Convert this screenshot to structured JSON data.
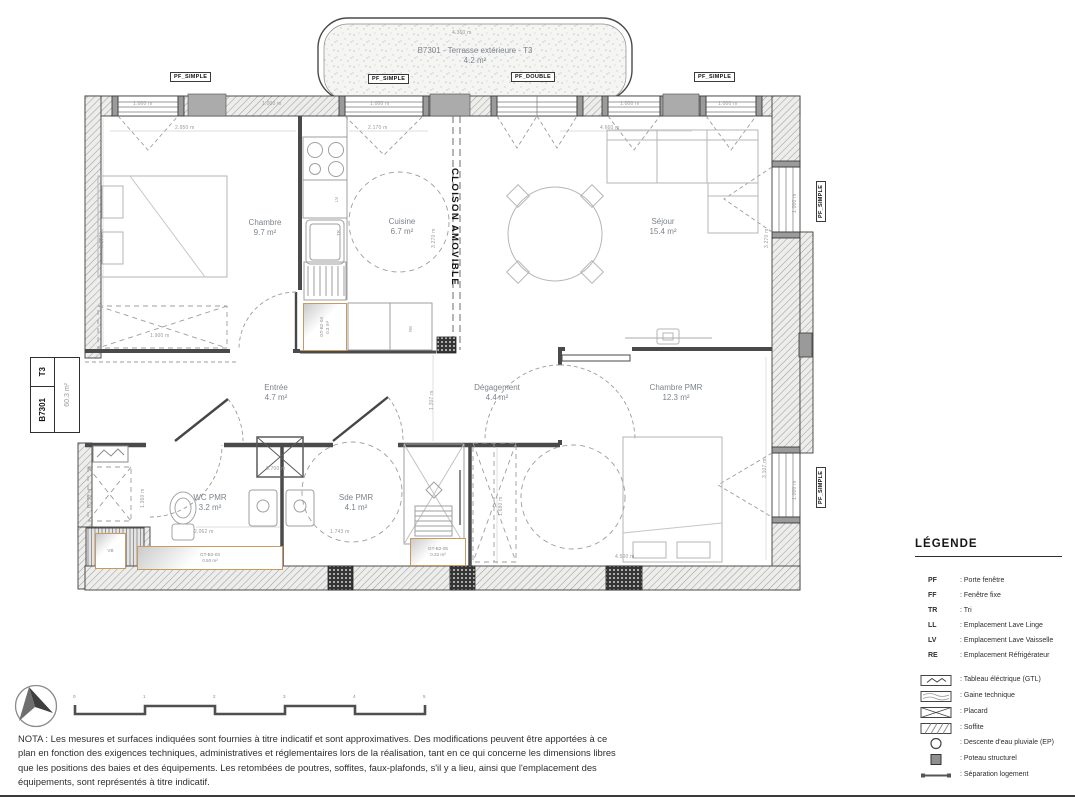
{
  "title_block": {
    "code": "B7301",
    "type": "T3",
    "area": "60.3 m²"
  },
  "terrace": {
    "name": "B7301 - Terrasse extérieure - T3",
    "area": "4.2 m²"
  },
  "rooms": {
    "chambre": {
      "name": "Chambre",
      "area": "9.7 m²"
    },
    "cuisine": {
      "name": "Cuisine",
      "area": "6.7 m²"
    },
    "sejour": {
      "name": "Séjour",
      "area": "15.4 m²"
    },
    "entree": {
      "name": "Entrée",
      "area": "4.7 m²"
    },
    "degagement": {
      "name": "Dégagement",
      "area": "4.4 m²"
    },
    "chambre_pmr": {
      "name": "Chambre PMR",
      "area": "12.3 m²"
    },
    "wc_pmr": {
      "name": "WC PMR",
      "area": "3.2 m²"
    },
    "sde_pmr": {
      "name": "Sde PMR",
      "area": "4.1 m²"
    }
  },
  "partition_label": "CLOISON AMOVIBLE",
  "window_tags": {
    "t1": "PF_SIMPLE",
    "t2": "PF_SIMPLE",
    "t3": "PF_DOUBLE",
    "t4": "PF_SIMPLE",
    "r1": "PF_SIMPLE",
    "r2": "PF_SIMPLE"
  },
  "ducts": {
    "gt04": {
      "id": "GT-B2-04",
      "area": "0.3 m²"
    },
    "gt03": {
      "id": "GT-B2-03",
      "area": "0.50 m²"
    },
    "gt05": {
      "id": "GT-B2-05",
      "area": "0.32 m²"
    },
    "vb": "VB"
  },
  "equipment": {
    "lv": "LV",
    "tr": "TR",
    "re": "RE"
  },
  "dims": [
    "4.360 m",
    "1.000 m",
    "1.000 m",
    "1.000 m",
    "1.000 m",
    "1.000 m",
    "2.950 m",
    "2.170 m",
    "4.660 m",
    "3.270 m",
    "3.270 m",
    "3.270 m",
    "1.900 m",
    "1.207 m",
    "0.700 m",
    "2.062 m",
    "1.743 m",
    "1.680 m",
    "4.500 m",
    "1.000 m",
    "1.000 m",
    "3.107 m",
    "1.360 m",
    "0.750 m"
  ],
  "legend": {
    "title": "LÉGENDE",
    "abbreviations": [
      {
        "key": "PF",
        "desc": ": Porte fenêtre"
      },
      {
        "key": "FF",
        "desc": ": Fenêtre fixe"
      },
      {
        "key": "TR",
        "desc": ": Tri"
      },
      {
        "key": "LL",
        "desc": ": Emplacement Lave Linge"
      },
      {
        "key": "LV",
        "desc": ": Emplacement Lave Vaisselle"
      },
      {
        "key": "RE",
        "desc": ": Emplacement Réfrigérateur"
      }
    ],
    "symbols": [
      {
        "icon": "electrical-panel-icon",
        "desc": ": Tableau éléctrique (GTL)"
      },
      {
        "icon": "technical-duct-icon",
        "desc": ": Gaine technique"
      },
      {
        "icon": "closet-icon",
        "desc": ": Placard"
      },
      {
        "icon": "soffit-icon",
        "desc": ": Soffite"
      },
      {
        "icon": "rainwater-downpipe-icon",
        "desc": ": Descente d'eau pluviale (EP)"
      },
      {
        "icon": "structural-post-icon",
        "desc": ": Poteau structurel"
      },
      {
        "icon": "unit-separation-icon",
        "desc": ": Séparation logement"
      }
    ]
  },
  "scale_bar": {
    "ticks": [
      "0",
      "1",
      "2",
      "3",
      "4",
      "5"
    ]
  },
  "nota": "NOTA : Les mesures et surfaces indiquées sont fournies à titre indicatif et sont approximatives. Des modifications peuvent être apportées à ce plan en fonction des exigences techniques, administratives et réglementaires lors de la réalisation, tant en ce qui concerne les dimensions libres que les positions des baies et des équipements. Les retombées de poutres, soffites, faux-plafonds, s'il y a lieu, ainsi que l'emplacement des équipements, sont représentés à titre indicatif."
}
